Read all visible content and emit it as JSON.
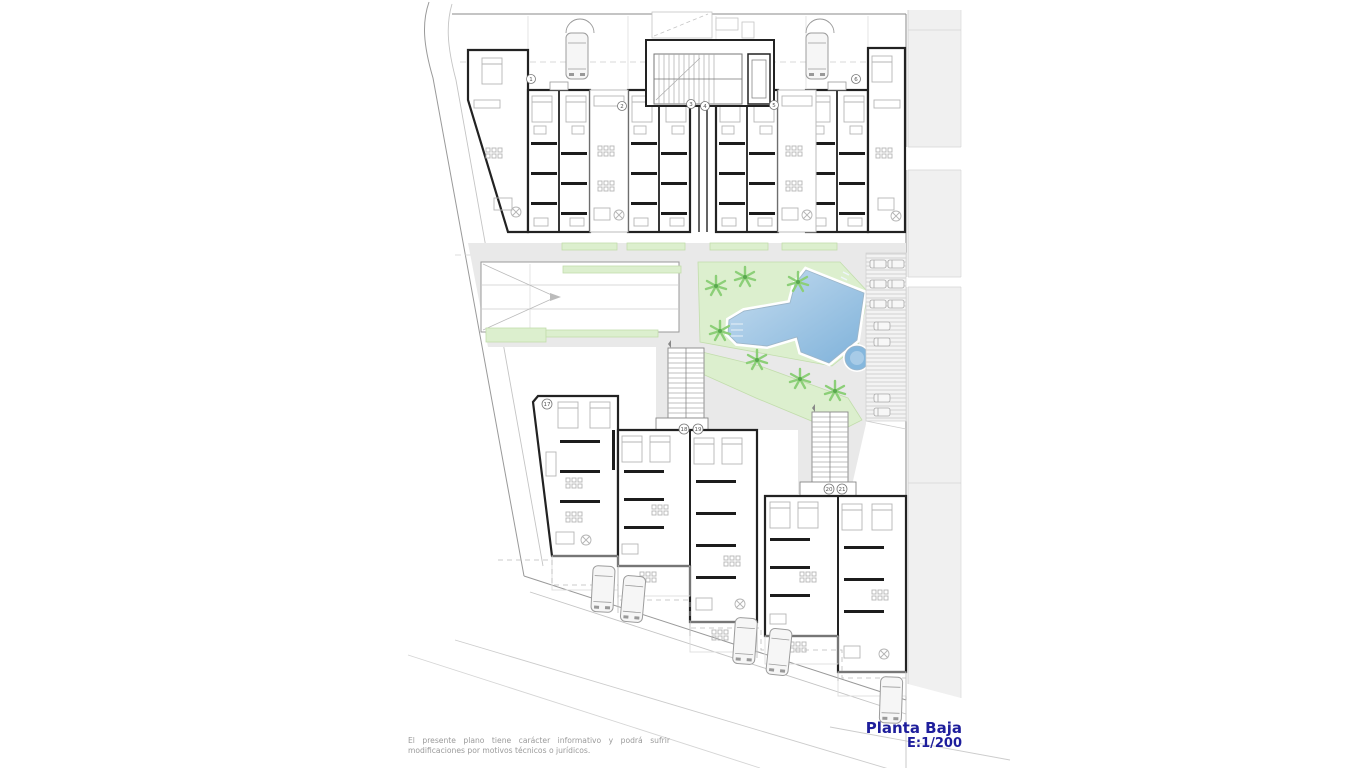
{
  "plan": {
    "title": "Planta Baja",
    "scale": "E:1/200",
    "disclaimer_line1": "El presente plano tiene carácter informativo y podrá sufrir",
    "disclaimer_line2": "modificaciones por motivos técnicos o jurídicos.",
    "unit_labels": [
      {
        "label": "1",
        "x": 531,
        "y": 79
      },
      {
        "label": "2",
        "x": 622,
        "y": 106
      },
      {
        "label": "3",
        "x": 691,
        "y": 104
      },
      {
        "label": "4",
        "x": 705,
        "y": 106
      },
      {
        "label": "5",
        "x": 774,
        "y": 105
      },
      {
        "label": "6",
        "x": 856,
        "y": 79
      },
      {
        "label": "17",
        "x": 547,
        "y": 404
      },
      {
        "label": "18",
        "x": 684,
        "y": 429
      },
      {
        "label": "19",
        "x": 698,
        "y": 429
      },
      {
        "label": "20",
        "x": 829,
        "y": 489
      },
      {
        "label": "21",
        "x": 842,
        "y": 489
      }
    ],
    "colors": {
      "title_text": "#1e1e9c",
      "garden_green": "#dcefce",
      "palm_green": "#8ccf78",
      "pool_blue_light": "#c6ddf0",
      "pool_blue_dark": "#7fb2da",
      "paving_gray": "#e9e9e9",
      "road_gray": "#f0f0f0",
      "wall_black": "#222222",
      "line_gray": "#999999",
      "disclaimer_gray": "#9a9a9a"
    }
  }
}
